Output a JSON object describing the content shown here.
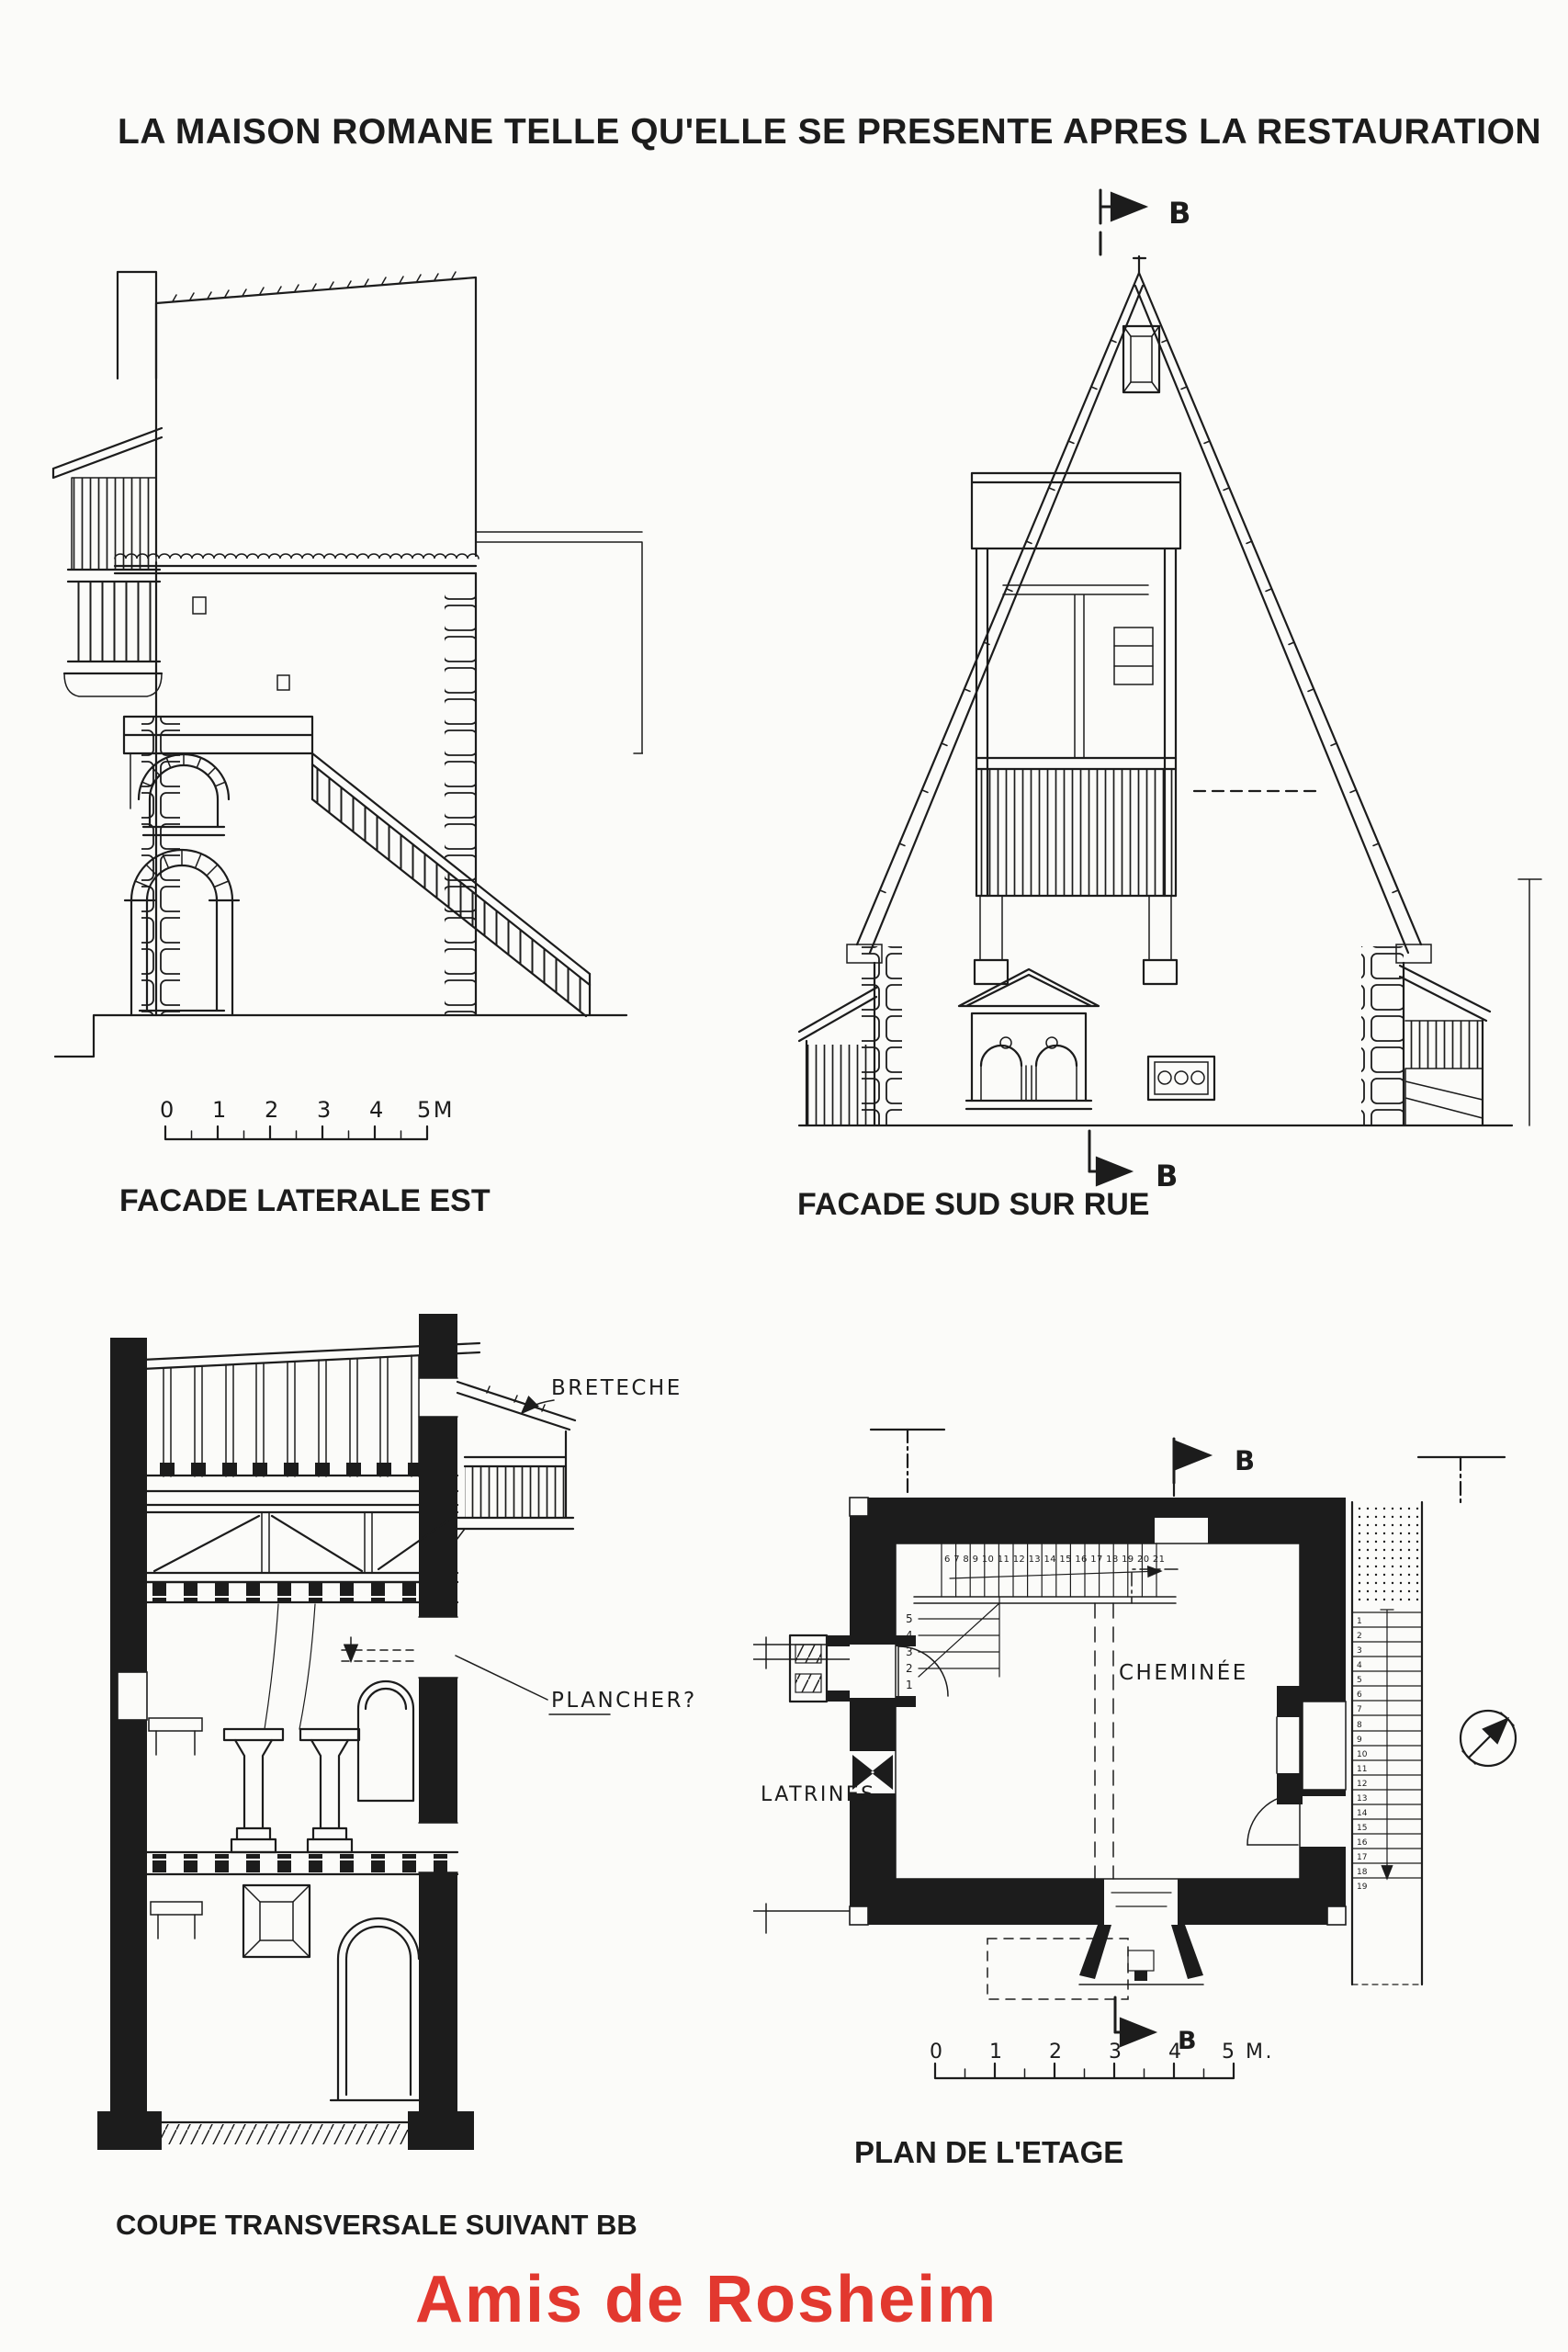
{
  "page": {
    "title": "LA MAISON ROMANE TELLE QU'ELLE SE PRESENTE APRES LA RESTAURATION",
    "credit": "Amis de Rosheim"
  },
  "colors": {
    "paper": "#fbfbf9",
    "ink": "#1c1c1c",
    "credit_red": "#e2382f"
  },
  "facade_est": {
    "caption": "FACADE LATERALE EST",
    "scale_ticks": [
      "0",
      "1",
      "2",
      "3",
      "4",
      "5M"
    ]
  },
  "facade_sud": {
    "caption": "FACADE SUD SUR RUE",
    "marker_top": "B",
    "marker_bottom": "B"
  },
  "coupe": {
    "caption": "COUPE TRANSVERSALE SUIVANT BB",
    "label_breteche": "BRETECHE",
    "label_plancher": "PLANCHER?"
  },
  "plan": {
    "caption": "PLAN DE L'ETAGE",
    "label_cheminee": "CHEMINÉE",
    "label_latrines": "LATRINES",
    "marker_top": "B",
    "marker_bottom": "B",
    "scale_ticks": [
      "0",
      "1",
      "2",
      "3",
      "4",
      "5 M."
    ],
    "stair_numbers_top": "6 7 8 9 10 11 12 13 14 15 16 17 18 19 20 21",
    "stair_numbers_left": [
      "5",
      "4",
      "3",
      "2",
      "1"
    ],
    "stair_numbers_right": [
      "1",
      "2",
      "3",
      "4",
      "5",
      "6",
      "7",
      "8",
      "9",
      "10",
      "11",
      "12",
      "13",
      "14",
      "15",
      "16",
      "17",
      "18",
      "19"
    ]
  }
}
